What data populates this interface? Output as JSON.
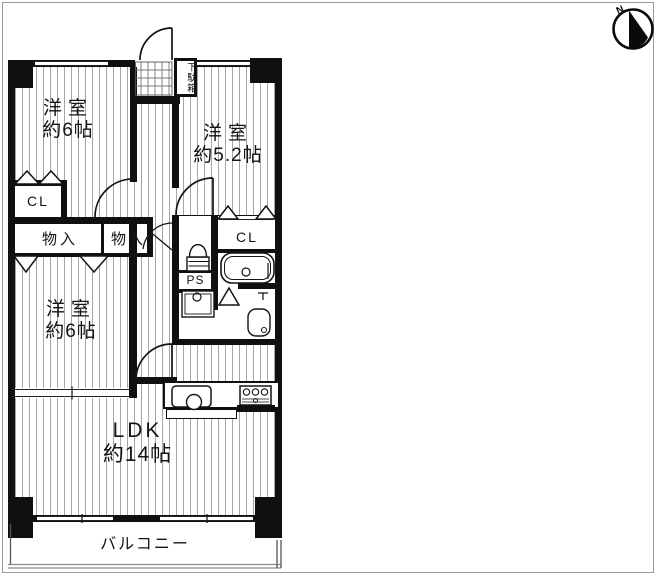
{
  "compass": {
    "label": "N",
    "icon": "compass-north-icon"
  },
  "rooms": {
    "bedroom_top_left": {
      "name": "洋室",
      "size": "約6帖"
    },
    "bedroom_top_right": {
      "name": "洋室",
      "size": "約5.2帖"
    },
    "bedroom_middle_left": {
      "name": "洋室",
      "size": "約6帖"
    },
    "ldk": {
      "name": "LDK",
      "size": "約14帖"
    },
    "balcony": {
      "name": "バルコニー"
    }
  },
  "labels": {
    "closet_top_left": "CL",
    "closet_right": "CL",
    "storage_left": "物入",
    "storage_right": "物入",
    "pipe_space": "PS",
    "shoe_cabinet": "下駄箱"
  },
  "icons": {
    "compass": "compass-north-icon",
    "toilet": "toilet-icon",
    "bathtub": "bathtub-icon",
    "washbasin": "washbasin-icon",
    "washing_machine": "washing-machine-pan-icon",
    "kitchen_sink": "kitchen-sink-icon",
    "stove": "stove-burner-icon",
    "entrance_tile": "entrance-tile-grid-icon",
    "door_swing": "door-swing-arc-icon",
    "folding_door": "folding-door-triangle-icon"
  },
  "colors": {
    "wall": "#101010",
    "floor_line": "#a6a6a6",
    "frame": "#9a9a9a",
    "background": "#ffffff"
  }
}
